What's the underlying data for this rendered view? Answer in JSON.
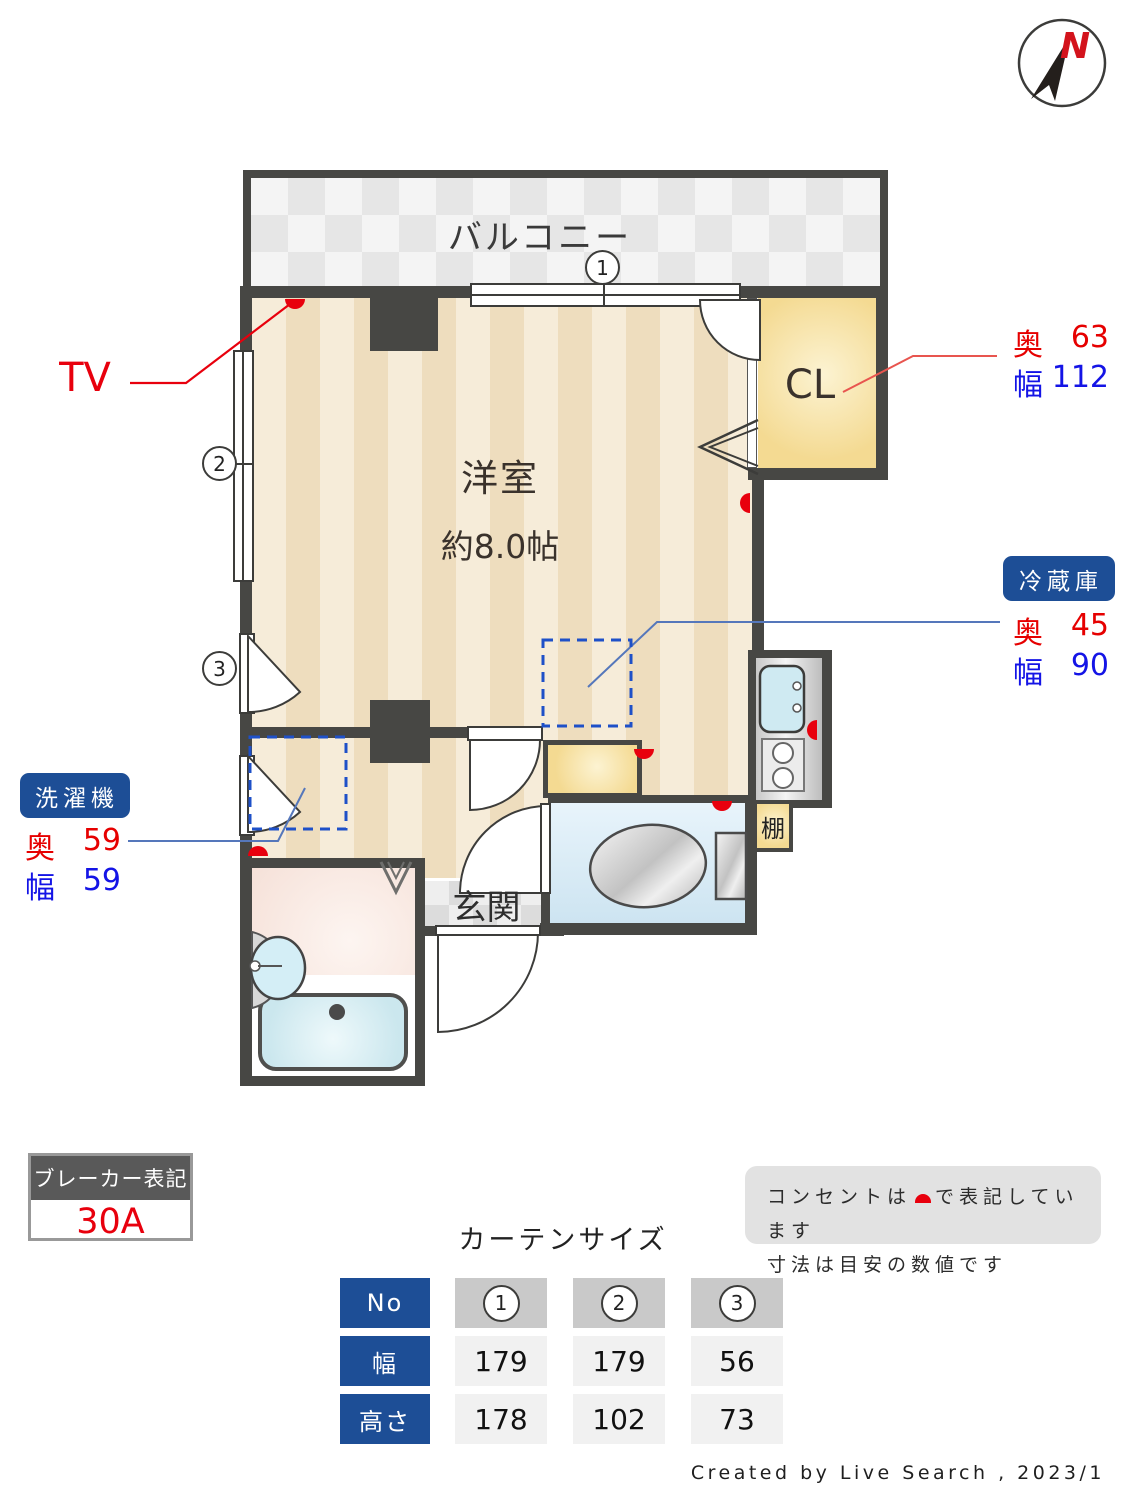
{
  "compass": {
    "label": "N"
  },
  "plan": {
    "balcony": "バルコニー",
    "room_name": "洋室",
    "room_size": "約8.0帖",
    "closet": "CL",
    "entrance": "玄関",
    "shelf": "棚",
    "tv": "TV",
    "windows": [
      "1",
      "2",
      "3"
    ]
  },
  "annotations": {
    "closet": {
      "depth_label": "奥",
      "depth_value": "63",
      "width_label": "幅",
      "width_value": "112"
    },
    "fridge": {
      "badge": "冷蔵庫",
      "depth_label": "奥",
      "depth_value": "45",
      "width_label": "幅",
      "width_value": "90"
    },
    "washer": {
      "badge": "洗濯機",
      "depth_label": "奥",
      "depth_value": "59",
      "width_label": "幅",
      "width_value": "59"
    }
  },
  "breaker": {
    "title": "ブレーカー表記",
    "value": "30A"
  },
  "notes": {
    "line1_pre": "コンセントは",
    "line1_post": "で表記しています",
    "line2": "寸法は目安の数値です"
  },
  "curtain": {
    "title": "カーテンサイズ",
    "row_headers": [
      "No",
      "幅",
      "高さ"
    ],
    "numbers": [
      "1",
      "2",
      "3"
    ],
    "width_values": [
      "179",
      "179",
      "56"
    ],
    "height_values": [
      "178",
      "102",
      "73"
    ]
  },
  "credit": "Created by Live Search , 2023/1",
  "colors": {
    "wall": "#474744",
    "accent_blue": "#1d4e96",
    "dim_red": "#e60000",
    "dim_blue": "#1414e6",
    "outlet_red": "#e8000d",
    "closet_yellow": "#f4da92"
  }
}
